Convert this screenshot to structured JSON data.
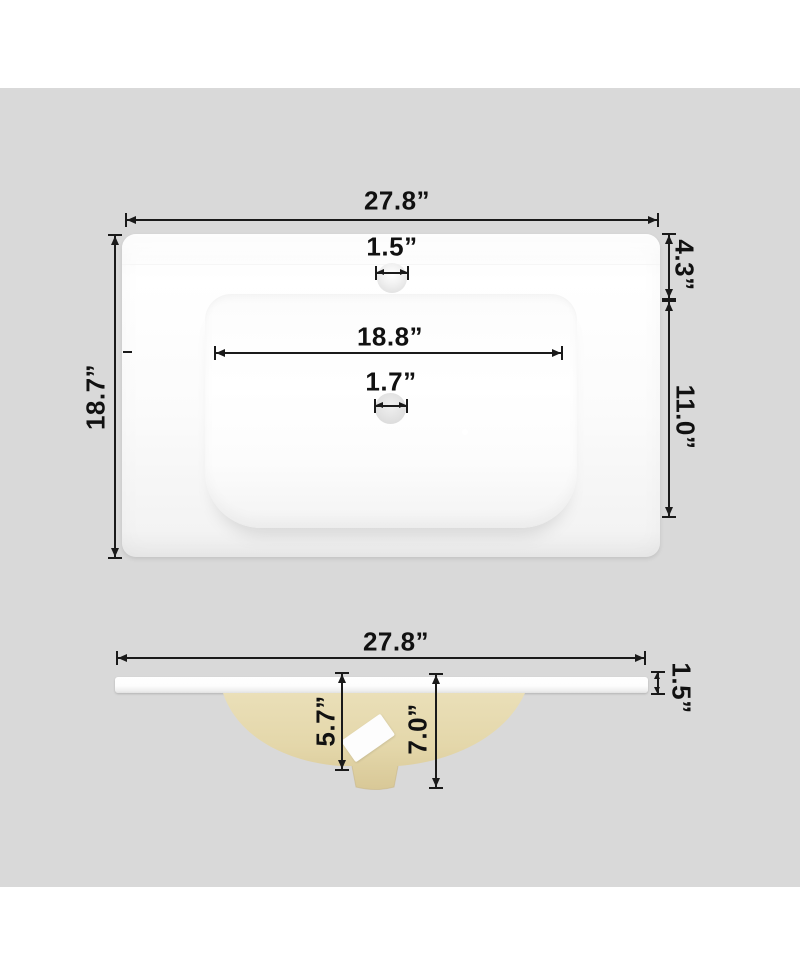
{
  "image": {
    "type": "product-dimension-diagram",
    "subject": "ceramic vanity sink top, top view and side view with measurements",
    "background_color": "#ffffff",
    "panel_color": "#d9d9d9",
    "line_color": "#1a1a1a",
    "countertop_color": "#fbfbfb",
    "basin_underside_color": "#e5d8ab"
  },
  "top_view": {
    "overall_width": "27.8”",
    "overall_depth": "18.7”",
    "faucet_hole_diameter": "1.5”",
    "basin_width": "18.8”",
    "drain_hole_diameter": "1.7”",
    "back_edge_to_basin": "4.3”",
    "basin_front_depth": "11.0”"
  },
  "side_view": {
    "overall_width": "27.8”",
    "countertop_thickness": "1.5”",
    "basin_depth": "5.7”",
    "overall_height": "7.0”"
  }
}
